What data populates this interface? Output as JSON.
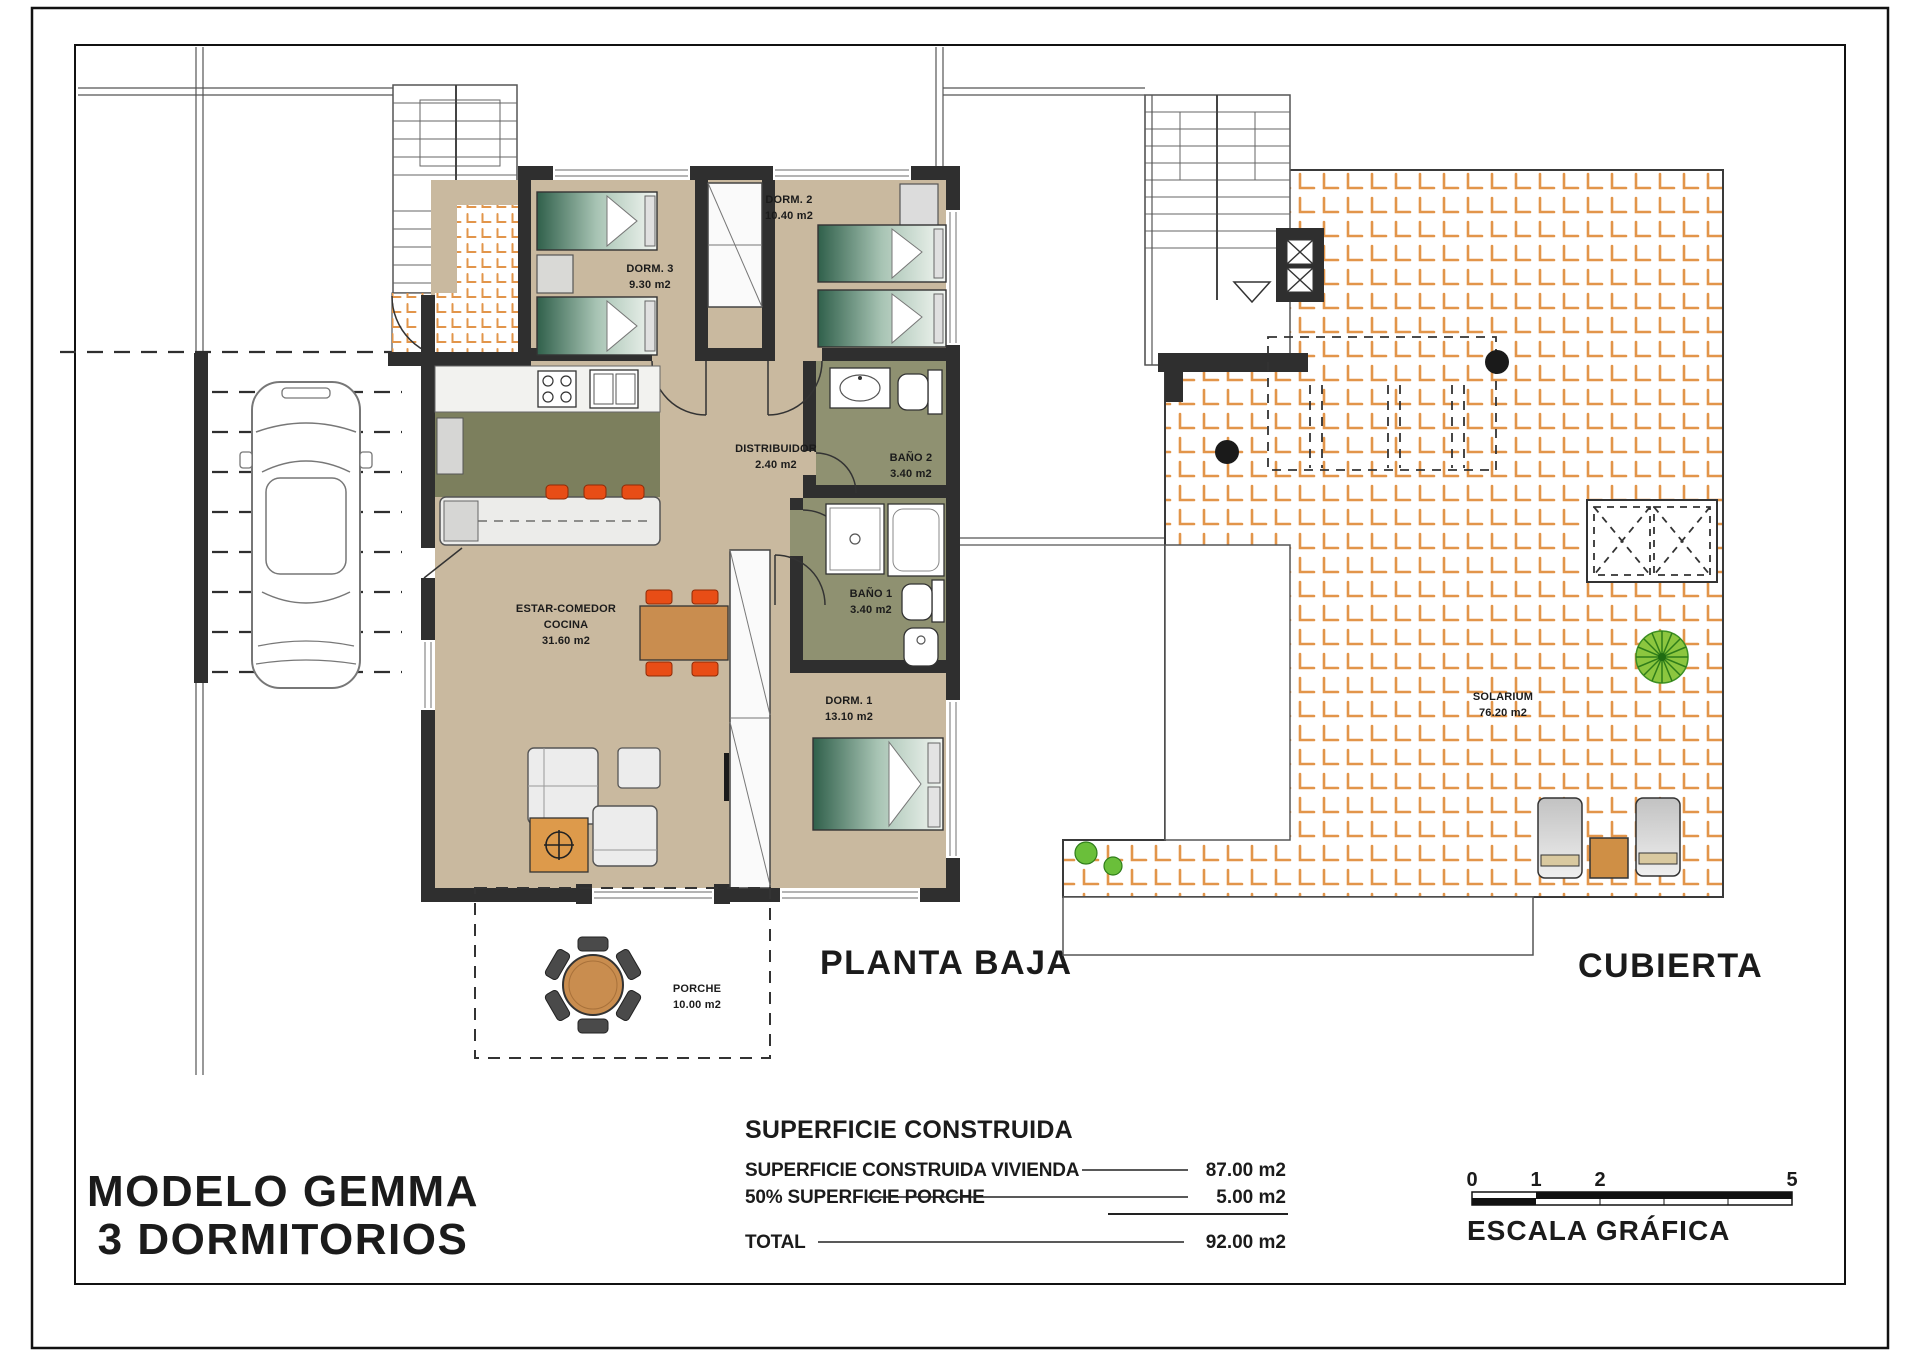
{
  "ground_floor": {
    "title": "PLANTA BAJA",
    "rooms": {
      "dorm3": {
        "name": "DORM. 3",
        "area": "9.30 m2"
      },
      "dorm2": {
        "name": "DORM. 2",
        "area": "10.40 m2"
      },
      "distribuidor": {
        "name": "DISTRIBUIDOR",
        "area": "2.40 m2"
      },
      "bano2": {
        "name": "BAÑO 2",
        "area": "3.40 m2"
      },
      "bano1": {
        "name": "BAÑO 1",
        "area": "3.40 m2"
      },
      "estar_comedor": {
        "name_line1": "ESTAR-COMEDOR",
        "name_line2": "COCINA",
        "area": "31.60 m2"
      },
      "dorm1": {
        "name": "DORM. 1",
        "area": "13.10 m2"
      },
      "porche": {
        "name": "PORCHE",
        "area": "10.00 m2"
      }
    }
  },
  "roof_plan": {
    "title": "CUBIERTA",
    "rooms": {
      "solarium": {
        "name": "SOLARIUM",
        "area": "76.20 m2"
      }
    }
  },
  "title_block": {
    "line1": "MODELO GEMMA",
    "line2": "3 DORMITORIOS"
  },
  "summary_table": {
    "title": "SUPERFICIE CONSTRUIDA",
    "rows": [
      {
        "label": "SUPERFICIE CONSTRUIDA VIVIENDA",
        "value": "87.00 m2"
      },
      {
        "label": "50% SUPERFICIE PORCHE",
        "value": "5.00 m2"
      },
      {
        "label": "TOTAL",
        "value": "92.00 m2"
      }
    ]
  },
  "scale_bar": {
    "label": "ESCALA GRÁFICA",
    "ticks": [
      "0",
      "1",
      "2",
      "5"
    ]
  },
  "colors": {
    "wall": "#2f2f2f",
    "floor_tan": "#c9b99f",
    "kitchen_olive": "#7c7f5d",
    "bath_olive": "#8f9171",
    "tile_orange": "#e2954a",
    "bed_green": "#30604b",
    "accent_orange": "#e84d16",
    "wood": "#c98d4f",
    "plant_green": "#6abf3a"
  }
}
